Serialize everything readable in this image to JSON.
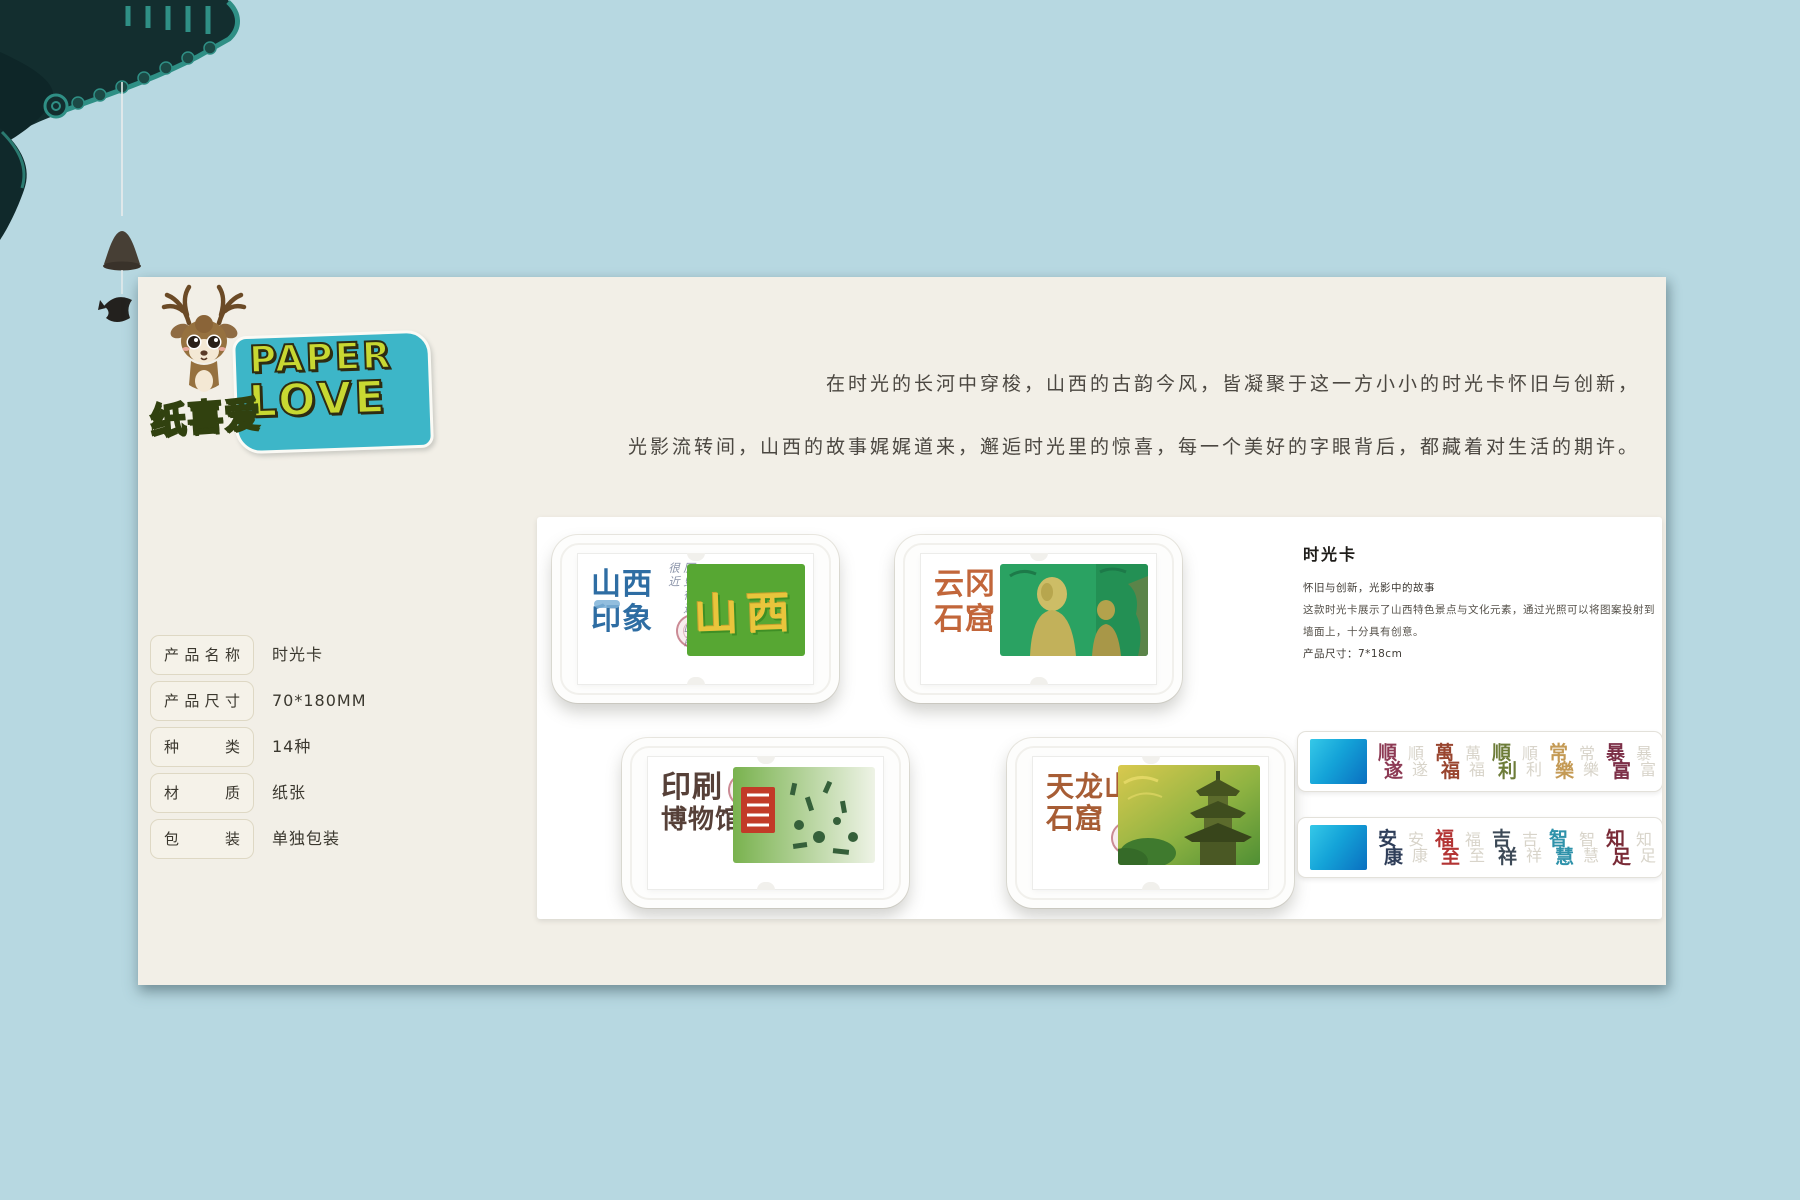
{
  "brand": {
    "name_en_line1": "PAPER",
    "name_en_line2": "LOVE",
    "name_cn": "纸喜爱",
    "sticker_color": "#3db6c8",
    "letter_color": "#c8d832",
    "cn_color": "#8cc63e"
  },
  "intro": {
    "line1": "在时光的长河中穿梭，山西的古韵今风，皆凝聚于这一方小小的时光卡怀旧与创新，",
    "line2": "光影流转间，山西的故事娓娓道来，邂逅时光里的惊喜，每一个美好的字眼背后，都藏着对生活的期许。"
  },
  "specs": {
    "rows": [
      {
        "label": "产品名称",
        "value": "时光卡"
      },
      {
        "label": "产品尺寸",
        "value": "70*180MM"
      },
      {
        "label": "种类",
        "value": "14种"
      },
      {
        "label": "材质",
        "value": "纸张"
      },
      {
        "label": "包装",
        "value": "单独包装"
      }
    ]
  },
  "cards": [
    {
      "title1": "山西",
      "title2": "印象",
      "color": "#2e6da3",
      "note1": "历史很远",
      "note2": "山西很近",
      "art": "山西"
    },
    {
      "title1": "云冈",
      "title2": "石窟",
      "color": "#c2663a"
    },
    {
      "title1": "印刷",
      "title2": "博物馆",
      "color": "#564038"
    },
    {
      "title1": "天龙山",
      "title2": "石窟",
      "color": "#a75d35"
    }
  ],
  "detail": {
    "title": "时光卡",
    "lines": [
      "怀旧与创新，光影中的故事",
      "这款时光卡展示了山西特色景点与文化元素，通过光照可以将图案投射到",
      "墙面上，十分具有创意。",
      "产品尺寸：7*18cm"
    ]
  },
  "strips": [
    {
      "words": [
        {
          "top": "順",
          "bottom": "遂",
          "color": "#8d3a54"
        },
        {
          "top": "萬",
          "bottom": "福",
          "color": "#99452f"
        },
        {
          "top": "順",
          "bottom": "利",
          "color": "#6d7c39"
        },
        {
          "top": "常",
          "bottom": "樂",
          "color": "#c49a55"
        },
        {
          "top": "暴",
          "bottom": "富",
          "color": "#7c2f47"
        }
      ]
    },
    {
      "words": [
        {
          "top": "安",
          "bottom": "康",
          "color": "#2f3e59"
        },
        {
          "top": "福",
          "bottom": "至",
          "color": "#b33434"
        },
        {
          "top": "吉",
          "bottom": "祥",
          "color": "#3c4956"
        },
        {
          "top": "智",
          "bottom": "慧",
          "color": "#2e92aa"
        },
        {
          "top": "知",
          "bottom": "足",
          "color": "#792a36"
        }
      ]
    }
  ]
}
